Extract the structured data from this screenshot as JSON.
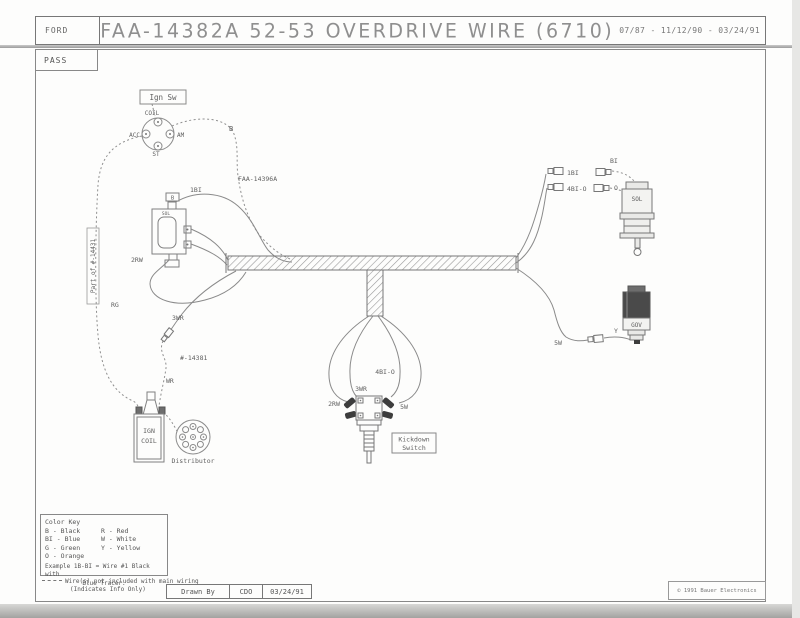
{
  "header": {
    "brand": "FORD",
    "title": "FAA-14382A  52-53 OVERDRIVE WIRE  (6710)",
    "dates": "07/87 - 11/12/90 - 03/24/91",
    "tab": "PASS"
  },
  "footer": {
    "drawn_by_label": "Drawn By",
    "drawn_by_initials": "CDO",
    "drawn_date": "03/24/91",
    "copyright": "© 1991 Bauer Electronics"
  },
  "components": {
    "ign_sw_label": "Ign Sw",
    "ign_sw_coil": "COIL",
    "ign_sw_acc": "ACC",
    "ign_sw_am": "AM",
    "ign_sw_st": "ST",
    "relay_term_b": "B",
    "relay_term_sol": "SOL",
    "coil_line1": "IGN",
    "coil_line2": "COIL",
    "distributor": "Distributor",
    "kickdown_line1": "Kickdown",
    "kickdown_line2": "Switch",
    "solenoid": "SOL",
    "governor": "GOV",
    "part_of_bracket": "Part of #-14431"
  },
  "wires": {
    "b": "B",
    "harness_part": "FAA-14396A",
    "relay_1bi": "1BI",
    "relay_2rw": "2RW",
    "left_3wr": "3WR",
    "rg": "RG",
    "p14381": "#-14381",
    "wr": "WR",
    "kd_2rw": "2RW",
    "kd_3wr": "3WR",
    "kd_4bio": "4BI-O",
    "kd_5w": "5W",
    "sol_1bi": "1BI",
    "sol_4bio": "4BI-O",
    "sol_bi": "BI",
    "sol_o": "O",
    "gov_5w": "5W",
    "gov_y": "Y"
  },
  "color_key": {
    "title": "Color Key",
    "col1": [
      "B - Black",
      "BI - Blue",
      "G - Green",
      "O - Orange"
    ],
    "col2": [
      "R - Red",
      "W - White",
      "Y - Yellow"
    ],
    "example_line1": "Example  1B-BI = Wire #1 Black with",
    "example_line2": "Blue Tracer.",
    "note_line1": "Wire(s) not included with main wiring",
    "note_line2": "(Indicates Info Only)"
  }
}
